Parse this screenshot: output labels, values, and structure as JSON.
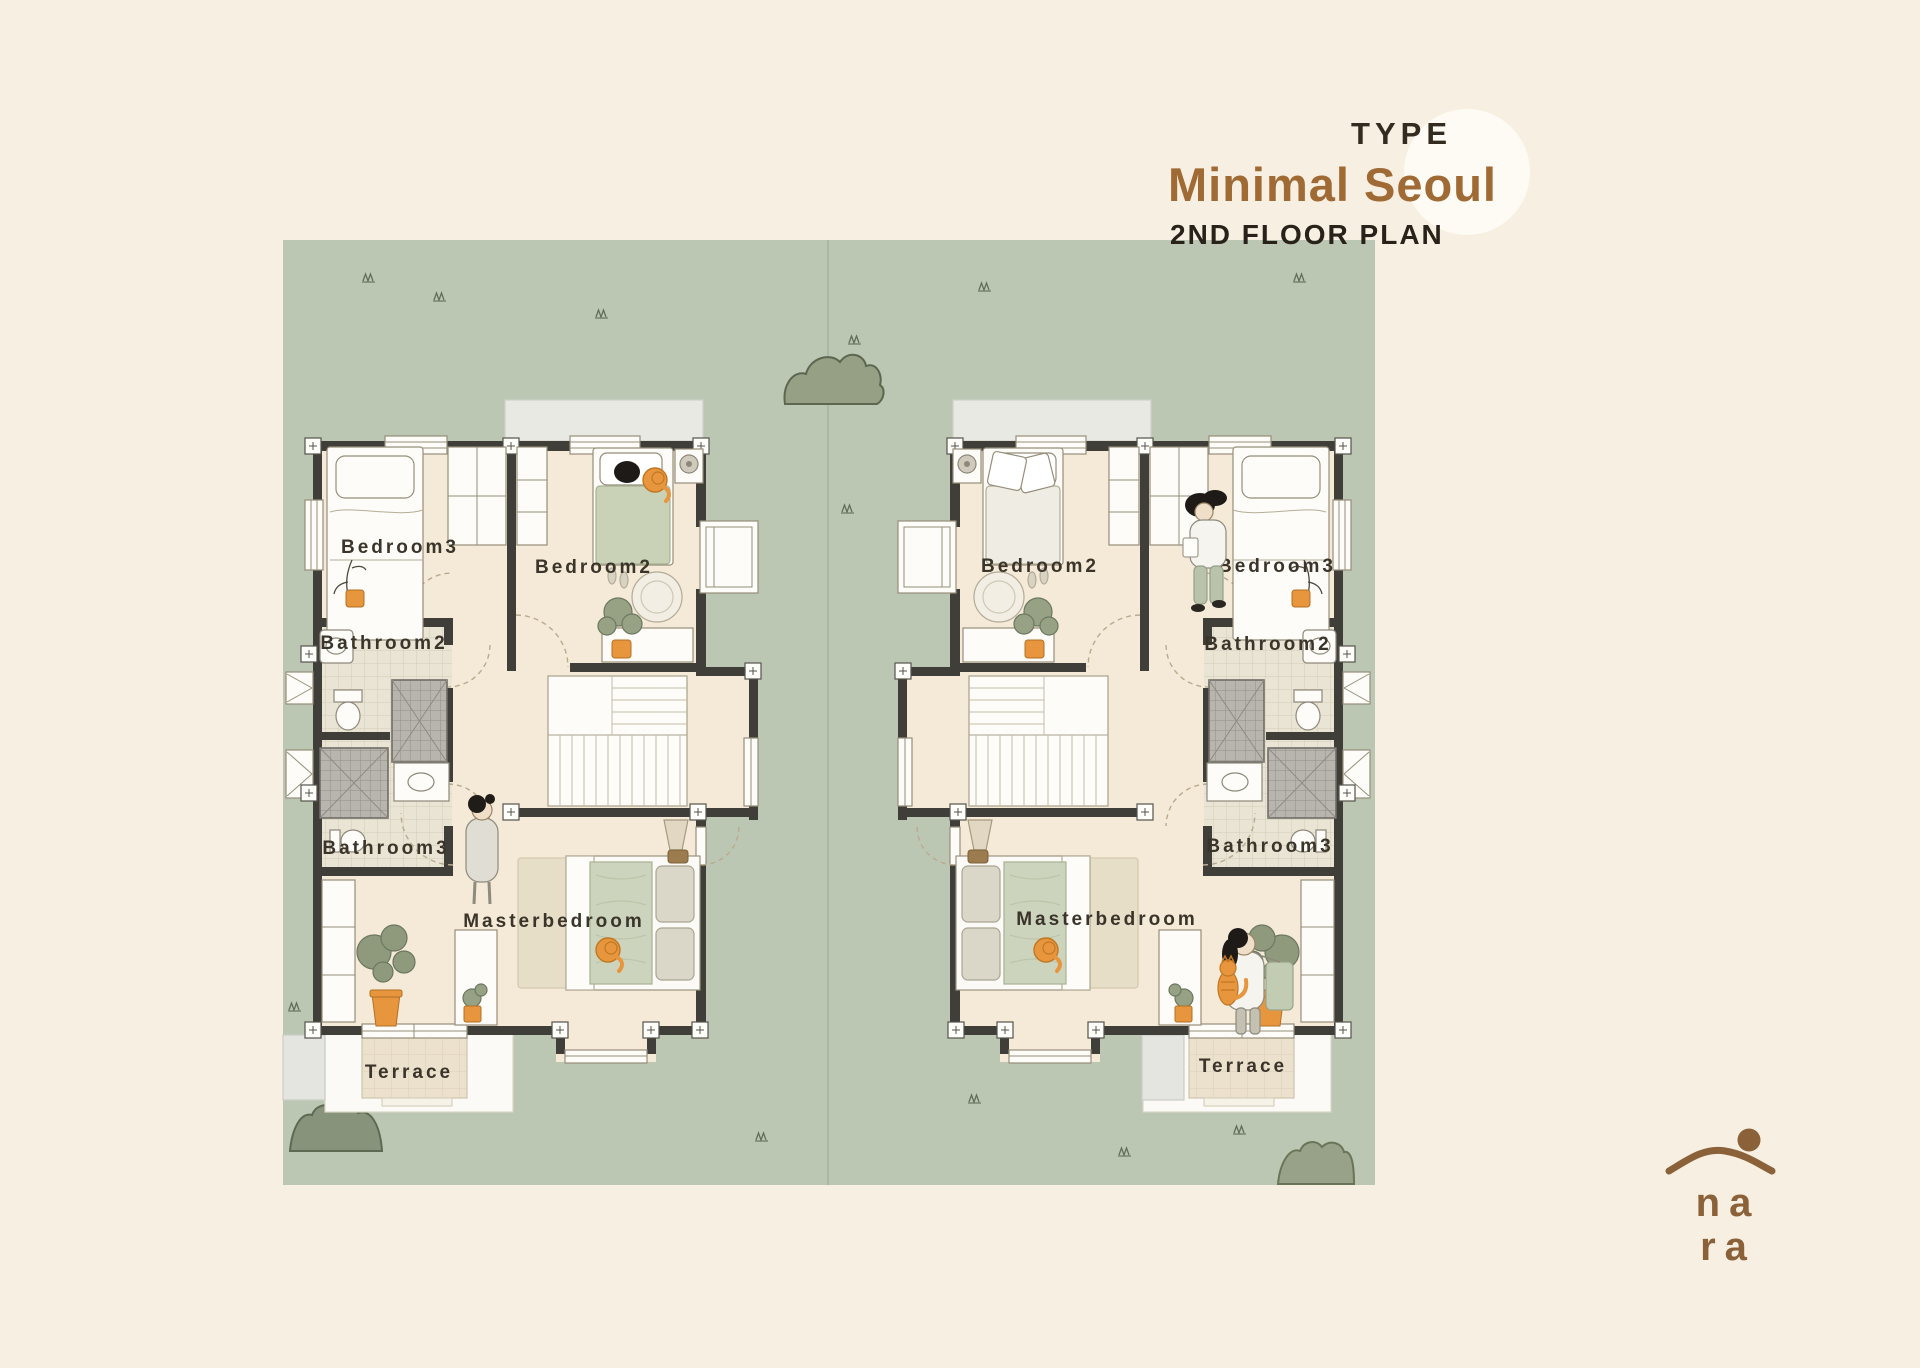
{
  "title_block": {
    "type_label": "TYPE",
    "plan_title": "Minimal Seoul",
    "floor_label": "2ND FLOOR PLAN"
  },
  "brand_logo": {
    "line1": "na",
    "line2": "ra",
    "icon": "house-roof-with-sun-icon"
  },
  "units": {
    "left": {
      "bedroom3": "Bedroom3",
      "bedroom2": "Bedroom2",
      "bathroom2": "Bathroom2",
      "bathroom3": "Bathroom3",
      "masterbedroom": "Masterbedroom",
      "terrace": "Terrace"
    },
    "right": {
      "bedroom2": "Bedroom2",
      "bedroom3": "Bedroom3",
      "bathroom2": "Bathroom2",
      "bathroom3": "Bathroom3",
      "masterbedroom": "Masterbedroom",
      "terrace": "Terrace"
    }
  },
  "colors": {
    "background": "#f7efe1",
    "site_green": "#bcc7b3",
    "floor_cream": "#f4ead7",
    "wall_dark": "#403e39",
    "accent_brown": "#a06a35",
    "text_dark": "#28221a",
    "logo_brown": "#8a6138",
    "orange": "#e8963e",
    "sage_furniture": "#ccd4bb",
    "shower_gray": "#b7b5ae",
    "highlight_circle": "#fdfbf4"
  }
}
